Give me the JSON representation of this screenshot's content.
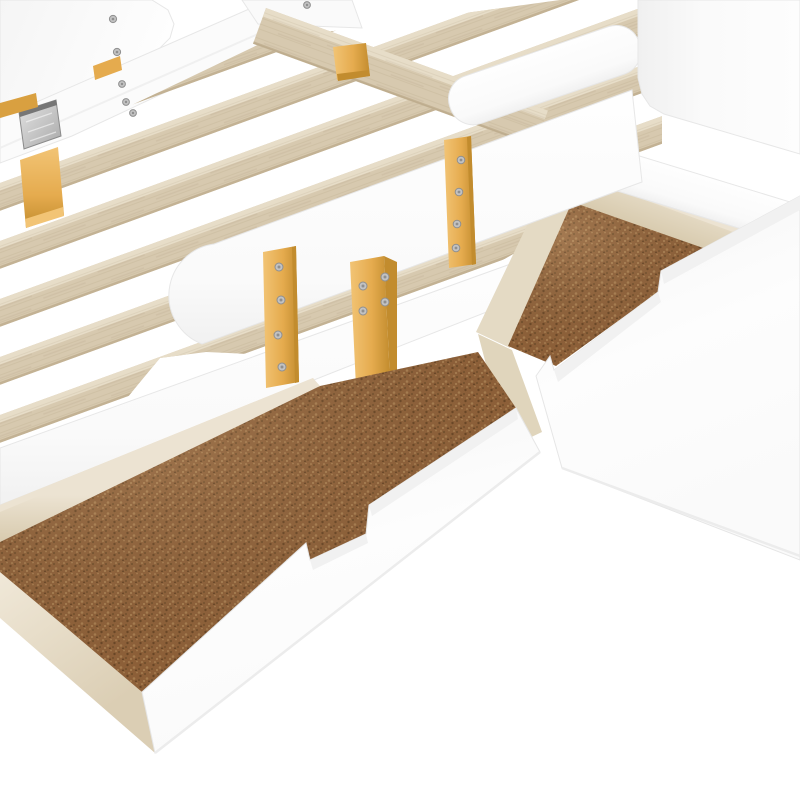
{
  "image": {
    "type": "product-photo-3d-render",
    "description": "White kids platform bed shown at an angle on a plain white background: headboard at upper left, footboard at upper right, pale wood support slats, white guard rails fastened with golden wood brackets and screws, and two pulled-out white storage drawers with light wood sides and brown cork-textured bottoms.",
    "background": "#ffffff"
  },
  "colors": {
    "bg": "#ffffff",
    "white-face": "#fcfcfc",
    "white-bright": "#ffffff",
    "white-shade": "#f1f1f1",
    "edge": "#e7e7e7",
    "slat": "#d7c9af",
    "slat-top": "#e7ddc8",
    "slat-dark": "#c3b294",
    "wood-pale": "#ece3d2",
    "wood-pale-mid": "#e2d7c0",
    "wood-pale-shade": "#d5c7a9",
    "gold": "#e5ab4e",
    "gold-light": "#f2c475",
    "gold-dark": "#c28c2e",
    "cork": "#8f6139",
    "cork-dark1": "#74502c",
    "cork-dark2": "#6b4726",
    "cork-light1": "#a97e50",
    "cork-light2": "#b8905e",
    "metal": "#c7c7c7",
    "metal-dark": "#8d8d8d",
    "screw": "#c2c2c2",
    "screw-rim": "#8f8f8f"
  },
  "parts": {
    "headboard_panel": "headboard panel",
    "headboard_rail": "headboard side rail",
    "metal_plate": "metal mounting plate",
    "headboard_leg": "wood leg",
    "bracket_tab_top": "small wood bracket",
    "bracket_tab_left": "small wood bracket",
    "slats": "wood support slats",
    "slat_count": 7,
    "far_rail": "far side rail",
    "far_ledge": "wood slat ledge",
    "far_gold_block": "wood mounting block",
    "footboard_panel": "footboard panel",
    "foot_rail": "footboard side rail",
    "guard_rail_near": "near guard rail",
    "guard_rail_far": "far guard rail",
    "bracket_a": "guard rail bracket",
    "bracket_b": "guard rail bracket",
    "bracket_c": "guard rail bracket",
    "side_rail": "bed side rail",
    "drawer_left": "storage drawer (front)",
    "drawer_right": "storage drawer (rear)",
    "drawer_bottom_material": "cork board drawer bottom",
    "drawer_handle": "notched finger-pull handle",
    "screw_total": 18
  }
}
